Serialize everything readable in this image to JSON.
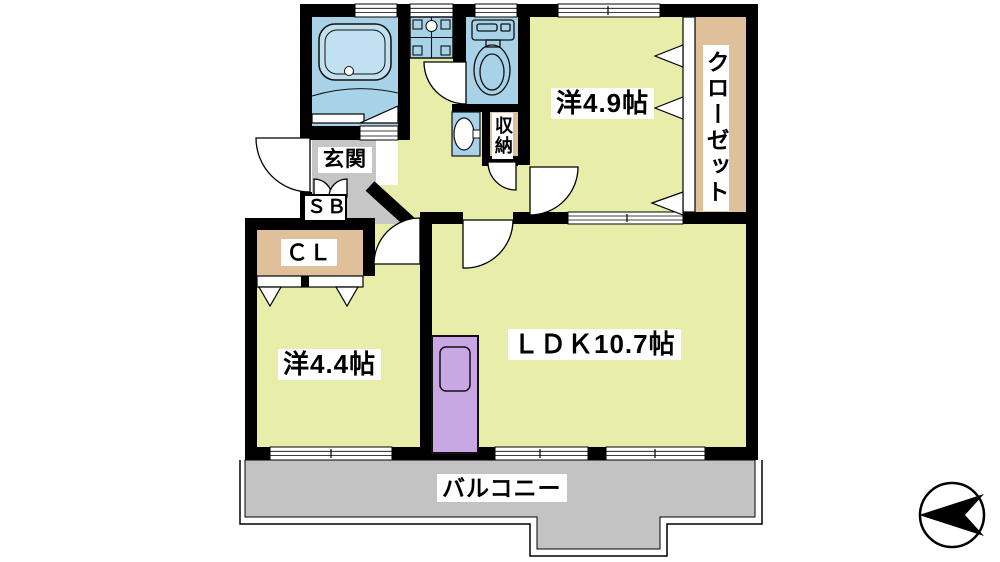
{
  "colors": {
    "room_yellow": "#e9edaa",
    "water_blue": "#a7d2e8",
    "tub_blue": "#c2e1f0",
    "closet_tan": "#dfc09a",
    "entrance_gray": "#c6c6c6",
    "balcony_gray": "#c3c3c3",
    "door_purple": "#c9a6e4",
    "wall_black": "#000000"
  },
  "labels": {
    "western_room_49": "洋4.9帖",
    "closet": "クローゼット",
    "storage": "収納",
    "entrance": "玄関",
    "shoe_box": "ＳＢ",
    "closet_cl": "ＣＬ",
    "western_room_44": "洋4.4帖",
    "ldk": "ＬＤＫ10.7帖",
    "balcony": "バルコニー"
  },
  "icons": {
    "compass": "north-arrow"
  }
}
